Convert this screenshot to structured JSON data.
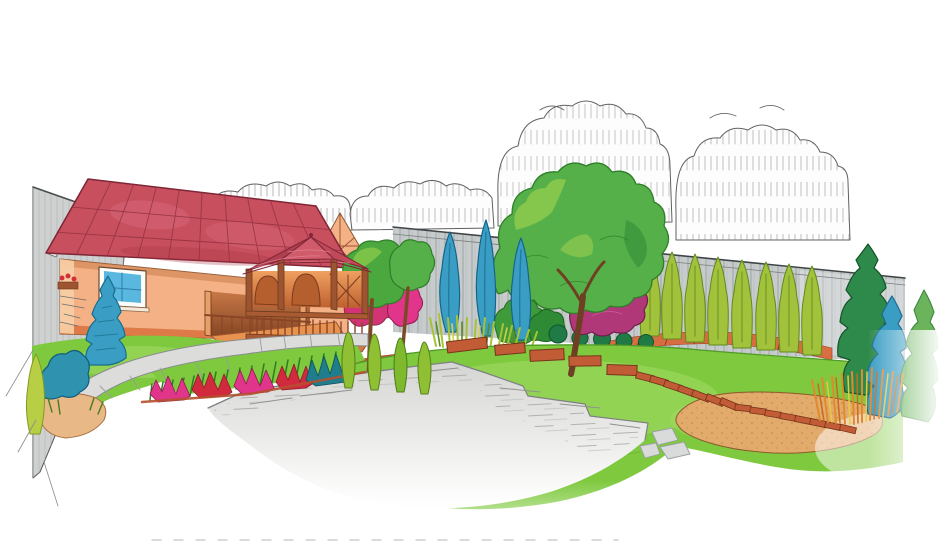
{
  "caption": {
    "title": "Перспективная зарисовка к концепции благоустройства №1"
  },
  "palette": {
    "paper_white": "#ffffff",
    "ink_grey": "#5a5a5a",
    "roof_red": "#c84f5e",
    "roof_dark": "#8e2f3e",
    "wall_peach": "#f3b185",
    "wall_shadow": "#d9824f",
    "wood_brown": "#a85a32",
    "wood_dark": "#6e3a1c",
    "window_blue": "#5ab8e0",
    "fence_grey": "#c7cbcc",
    "fence_line": "#8d9496",
    "side_wall_grey": "#cfd1d0",
    "lawn_green": "#7ec93e",
    "lawn_light": "#a8dd6a",
    "lawn_dark": "#4f9a28",
    "conifer_blue": "#3a9ec4",
    "conifer_blue_dark": "#176d8c",
    "cypress_green": "#a3c23c",
    "cypress_dark": "#5f8a1e",
    "tree_green": "#56b04a",
    "tree_light": "#9ed34d",
    "tree_dark": "#2e7d27",
    "dark_conifer_green": "#2e8a4a",
    "magenta_bush": "#b03878",
    "flower_pink": "#e0358a",
    "flower_red": "#d12a3e",
    "teal_plant": "#1f7d8e",
    "mulch_orange": "#d9693a",
    "mulch_red": "#c24a2a",
    "paver_terracotta": "#c25c36",
    "paver_outline": "#77341a",
    "sand_tan": "#e2ab6c",
    "sand_speckle": "#aa763c",
    "patio_grey": "#d6d6d4",
    "patio_line": "#9b9e9d",
    "grass_accent_orange": "#e08a2e"
  }
}
